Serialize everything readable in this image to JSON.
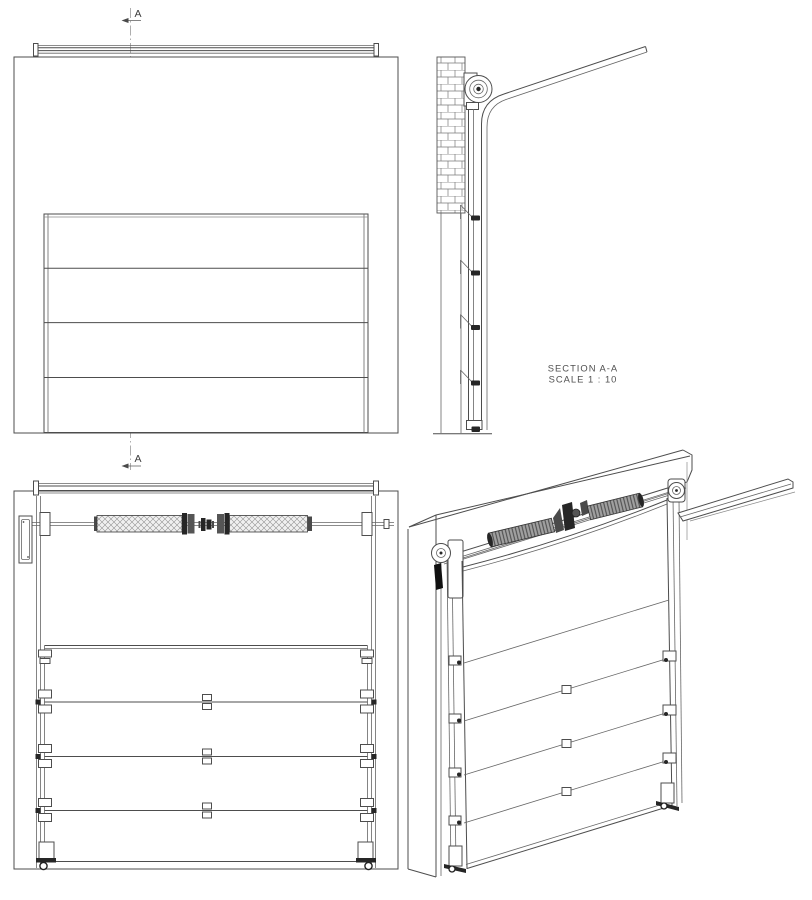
{
  "labels": {
    "section_title": "SECTION A-A",
    "section_scale": "SCALE 1 : 10",
    "marker_top": "A",
    "marker_bottom": "A"
  },
  "colors": {
    "background": "#ffffff",
    "line": "#4d4d4d",
    "line_light": "#8a8a8a",
    "dark_fill": "#262626",
    "rear_spring_fill": "#f2f2f2",
    "iso_spring_fill": "#a0a0a0"
  }
}
